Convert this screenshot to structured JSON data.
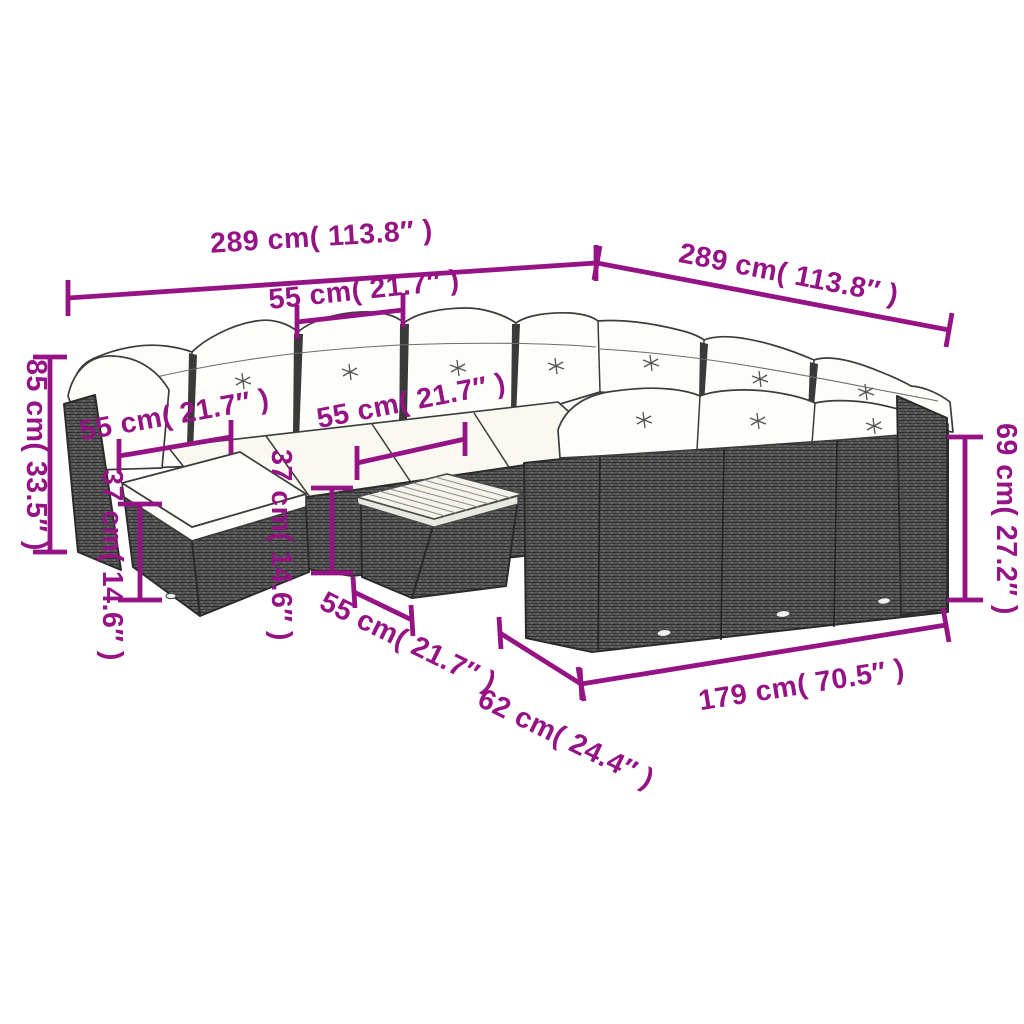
{
  "diagram": {
    "kind": "furniture-dimension-diagram",
    "colors": {
      "dimension_annotation": "#951384",
      "rattan_dark": "#4e4e4e",
      "cushion_white": "#fdfdfa",
      "background": "#ffffff"
    },
    "dimensions": {
      "back_width_left": "289 cm( 113.8″ )",
      "back_width_right": "289 cm( 113.8″ )",
      "seat_width_top": "55 cm( 21.7″ )",
      "seat_width_left": "55 cm( 21.7″ )",
      "seat_width_mid": "55 cm( 21.7″ )",
      "table_width_front": "55 cm( 21.7″ )",
      "total_height_left": "85 cm( 33.5″ )",
      "seat_height_left": "37 cm( 14.6″ )",
      "seat_height_mid": "37 cm( 14.6″ )",
      "back_height_right": "69 cm( 27.2″ )",
      "front_section_width": "179 cm( 70.5″ )",
      "table_depth": "62 cm( 24.4″ )"
    }
  }
}
